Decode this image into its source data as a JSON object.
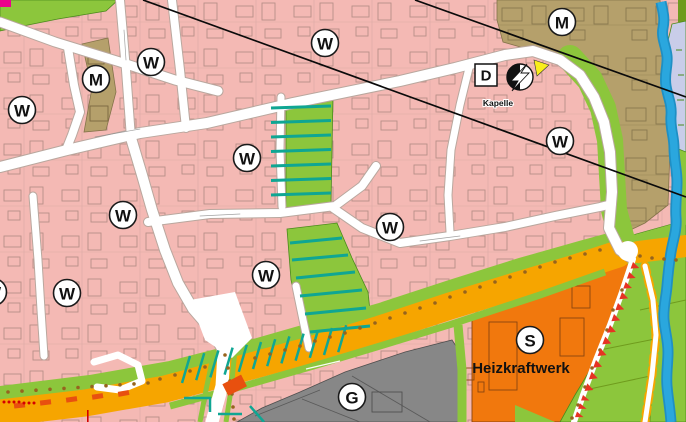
{
  "map": {
    "title": "Flächennutzungsplan Ausschnitt",
    "zone_markers": [
      {
        "letter": "W",
        "x": 22,
        "y": 110
      },
      {
        "letter": "M",
        "x": 96,
        "y": 79
      },
      {
        "letter": "W",
        "x": 151,
        "y": 62
      },
      {
        "letter": "W",
        "x": 325,
        "y": 43
      },
      {
        "letter": "M",
        "x": 562,
        "y": 22
      },
      {
        "letter": "W",
        "x": 560,
        "y": 141
      },
      {
        "letter": "W",
        "x": 247,
        "y": 158
      },
      {
        "letter": "W",
        "x": 123,
        "y": 215
      },
      {
        "letter": "W",
        "x": 390,
        "y": 227
      },
      {
        "letter": "W",
        "x": 266,
        "y": 275
      },
      {
        "letter": "W",
        "x": 67,
        "y": 293
      },
      {
        "letter": "W",
        "x": -7,
        "y": 292
      },
      {
        "letter": "S",
        "x": 530,
        "y": 340
      },
      {
        "letter": "G",
        "x": 352,
        "y": 397
      }
    ],
    "square_marker": {
      "letter": "D"
    },
    "labels": {
      "chapel": "Kapelle",
      "power_plant": "Heizkraftwerk"
    },
    "symbols": {
      "electricity": "lightning-circle",
      "power_line_count": 2
    },
    "colors": {
      "residential_pink": "#f4b9b4",
      "mixed_use_brown": "#b5a06b",
      "green_space": "#8cc63c",
      "tree_teal": "#0fa693",
      "special_orange": "#f1780d",
      "commercial_gray": "#878787",
      "main_road_band": "#f6a500",
      "water_blue": "#2aa7de",
      "planting_red": "#e63323",
      "road_dash_red": "#e8500f",
      "tree_dot_brown": "#96641e",
      "garden_lavender": "#c9cde9",
      "highlight_yellow": "#f9ed1b",
      "accent_magenta": "#ec008c"
    }
  }
}
